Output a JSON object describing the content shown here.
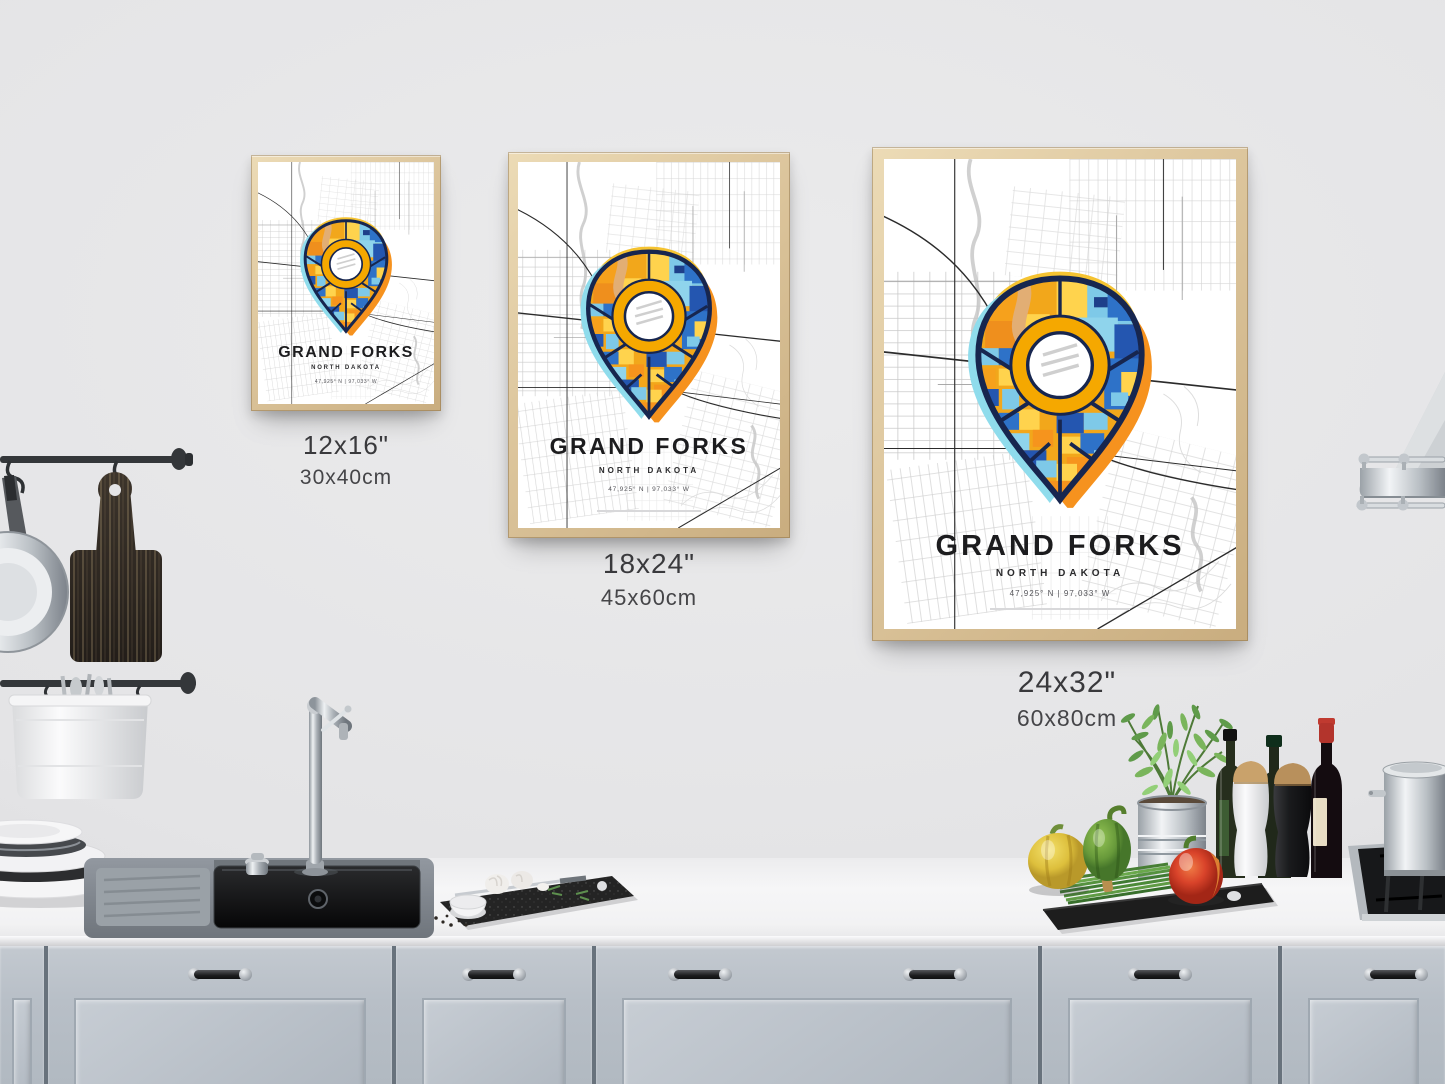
{
  "poster": {
    "city": "GRAND FORKS",
    "state": "NORTH DAKOTA",
    "coordinates": "47,925° N | 97,033° W"
  },
  "size_labels": [
    {
      "inches": "12x16\"",
      "cm": "30x40cm"
    },
    {
      "inches": "18x24\"",
      "cm": "45x60cm"
    },
    {
      "inches": "24x32\"",
      "cm": "60x80cm"
    }
  ],
  "icons": {
    "map_pin": "teardrop-location-marker"
  },
  "colors": {
    "wall": "#e4e4e6",
    "frame_wood": "#dcc59c",
    "cabinets": "#b8bfc7",
    "countertop": "#f4f4f5",
    "pin_navy": "#17264f",
    "pin_blue": "#2e72c8",
    "pin_sky": "#7ec9e8",
    "pin_amber": "#f2a71b",
    "pin_yellow": "#ffd34d",
    "glow_cyan": "#8fdcec",
    "glow_orange": "#f6921e"
  }
}
